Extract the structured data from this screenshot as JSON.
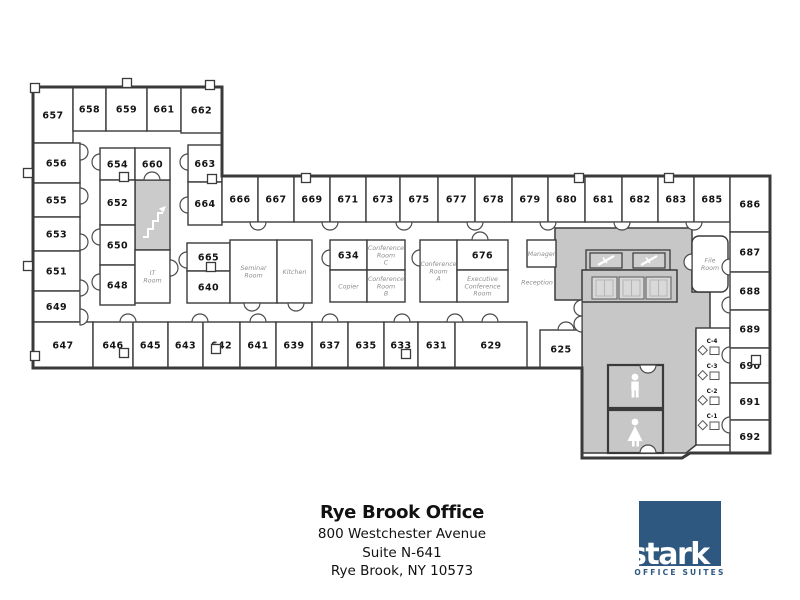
{
  "footer": {
    "title": "Rye Brook Office",
    "address_line1": "800 Westchester Avenue",
    "address_line2": "Suite N-641",
    "address_line3": "Rye Brook, NY 10573"
  },
  "logo": {
    "wordmark": "stark",
    "tagline": "OFFICE SUITES",
    "color": "#2e5880"
  },
  "colors": {
    "wall": "#3a3a3a",
    "room_fill": "#ffffff",
    "core_fill": "#c7c7c7",
    "stairs_fill": "#cbcbcb",
    "elevator_panel": "#d9d9d9",
    "number_label": "#141414",
    "name_label": "#8f8f8f"
  },
  "floorplan": {
    "outline": "M33,87 L222,87 L222,176 L770,176 L770,453 L690,453 L682,458 L582,458 L582,368 L33,368 Z",
    "core_path": "M555,228 L692,228 L692,292 L710,292 L710,330 L696,330 L696,445 L686,453 L582,453 L582,300 L555,300 Z",
    "stairs": {
      "x": 135,
      "y": 180,
      "w": 35,
      "h": 70
    },
    "strip": {
      "x": 696,
      "y": 328,
      "w": 34,
      "h": 117
    },
    "elevator": {
      "band": {
        "x": 586,
        "y": 250,
        "w": 84,
        "h": 20
      },
      "shafts": [
        {
          "x": 590,
          "y": 253,
          "w": 32,
          "h": 15
        },
        {
          "x": 633,
          "y": 253,
          "w": 32,
          "h": 15
        }
      ],
      "lobby": {
        "x": 582,
        "y": 270,
        "w": 95,
        "h": 32
      },
      "doors": [
        {
          "x": 592,
          "y": 277,
          "w": 25,
          "h": 22
        },
        {
          "x": 619,
          "y": 277,
          "w": 25,
          "h": 22
        },
        {
          "x": 646,
          "y": 277,
          "w": 25,
          "h": 22
        }
      ]
    },
    "restrooms": {
      "mens": {
        "x": 608,
        "y": 365,
        "w": 55,
        "h": 43
      },
      "womens": {
        "x": 608,
        "y": 410,
        "w": 55,
        "h": 43
      }
    },
    "rooms": [
      {
        "id": "657",
        "kind": "num",
        "lines": [
          "657"
        ],
        "x": 33,
        "y": 87,
        "w": 40,
        "h": 56
      },
      {
        "id": "658",
        "kind": "num",
        "lines": [
          "658"
        ],
        "x": 73,
        "y": 87,
        "w": 33,
        "h": 44
      },
      {
        "id": "659",
        "kind": "num",
        "lines": [
          "659"
        ],
        "x": 106,
        "y": 87,
        "w": 41,
        "h": 44
      },
      {
        "id": "661",
        "kind": "num",
        "lines": [
          "661"
        ],
        "x": 147,
        "y": 87,
        "w": 34,
        "h": 44
      },
      {
        "id": "662",
        "kind": "num",
        "lines": [
          "662"
        ],
        "x": 181,
        "y": 87,
        "w": 41,
        "h": 46
      },
      {
        "id": "656",
        "kind": "num",
        "lines": [
          "656"
        ],
        "x": 33,
        "y": 143,
        "w": 47,
        "h": 40
      },
      {
        "id": "655",
        "kind": "num",
        "lines": [
          "655"
        ],
        "x": 33,
        "y": 183,
        "w": 47,
        "h": 34
      },
      {
        "id": "653",
        "kind": "num",
        "lines": [
          "653"
        ],
        "x": 33,
        "y": 217,
        "w": 47,
        "h": 34
      },
      {
        "id": "651",
        "kind": "num",
        "lines": [
          "651"
        ],
        "x": 33,
        "y": 251,
        "w": 47,
        "h": 40
      },
      {
        "id": "649",
        "kind": "num",
        "lines": [
          "649"
        ],
        "x": 33,
        "y": 291,
        "w": 47,
        "h": 31
      },
      {
        "id": "647",
        "kind": "num",
        "lines": [
          "647"
        ],
        "x": 33,
        "y": 322,
        "w": 60,
        "h": 46
      },
      {
        "id": "654",
        "kind": "num",
        "lines": [
          "654"
        ],
        "x": 100,
        "y": 148,
        "w": 35,
        "h": 32
      },
      {
        "id": "660",
        "kind": "num",
        "lines": [
          "660"
        ],
        "x": 135,
        "y": 148,
        "w": 35,
        "h": 32
      },
      {
        "id": "652",
        "kind": "num",
        "lines": [
          "652"
        ],
        "x": 100,
        "y": 180,
        "w": 35,
        "h": 45
      },
      {
        "id": "650",
        "kind": "num",
        "lines": [
          "650"
        ],
        "x": 100,
        "y": 225,
        "w": 35,
        "h": 40
      },
      {
        "id": "648",
        "kind": "num",
        "lines": [
          "648"
        ],
        "x": 100,
        "y": 265,
        "w": 35,
        "h": 40
      },
      {
        "id": "it-room",
        "kind": "name",
        "lines": [
          "IT",
          "Room"
        ],
        "x": 135,
        "y": 250,
        "w": 35,
        "h": 53
      },
      {
        "id": "663",
        "kind": "num",
        "lines": [
          "663"
        ],
        "x": 188,
        "y": 145,
        "w": 34,
        "h": 37
      },
      {
        "id": "664",
        "kind": "num",
        "lines": [
          "664"
        ],
        "x": 188,
        "y": 182,
        "w": 34,
        "h": 43
      },
      {
        "id": "665",
        "kind": "num",
        "lines": [
          "665"
        ],
        "x": 187,
        "y": 243,
        "w": 43,
        "h": 28
      },
      {
        "id": "640",
        "kind": "num",
        "lines": [
          "640"
        ],
        "x": 187,
        "y": 271,
        "w": 43,
        "h": 32
      },
      {
        "id": "seminar-room",
        "kind": "name",
        "lines": [
          "Seminar",
          "Room"
        ],
        "x": 230,
        "y": 240,
        "w": 47,
        "h": 63
      },
      {
        "id": "kitchen",
        "kind": "name",
        "lines": [
          "Kitchen"
        ],
        "x": 277,
        "y": 240,
        "w": 35,
        "h": 63
      },
      {
        "id": "666",
        "kind": "num",
        "lines": [
          "666"
        ],
        "x": 222,
        "y": 176,
        "w": 36,
        "h": 46
      },
      {
        "id": "667",
        "kind": "num",
        "lines": [
          "667"
        ],
        "x": 258,
        "y": 176,
        "w": 36,
        "h": 46
      },
      {
        "id": "669",
        "kind": "num",
        "lines": [
          "669"
        ],
        "x": 294,
        "y": 176,
        "w": 36,
        "h": 46
      },
      {
        "id": "671",
        "kind": "num",
        "lines": [
          "671"
        ],
        "x": 330,
        "y": 176,
        "w": 36,
        "h": 46
      },
      {
        "id": "673",
        "kind": "num",
        "lines": [
          "673"
        ],
        "x": 366,
        "y": 176,
        "w": 34,
        "h": 46
      },
      {
        "id": "675",
        "kind": "num",
        "lines": [
          "675"
        ],
        "x": 400,
        "y": 176,
        "w": 38,
        "h": 46
      },
      {
        "id": "677",
        "kind": "num",
        "lines": [
          "677"
        ],
        "x": 438,
        "y": 176,
        "w": 37,
        "h": 46
      },
      {
        "id": "678",
        "kind": "num",
        "lines": [
          "678"
        ],
        "x": 475,
        "y": 176,
        "w": 37,
        "h": 46
      },
      {
        "id": "679",
        "kind": "num",
        "lines": [
          "679"
        ],
        "x": 512,
        "y": 176,
        "w": 36,
        "h": 46
      },
      {
        "id": "680",
        "kind": "num",
        "lines": [
          "680"
        ],
        "x": 548,
        "y": 176,
        "w": 37,
        "h": 46
      },
      {
        "id": "681",
        "kind": "num",
        "lines": [
          "681"
        ],
        "x": 585,
        "y": 176,
        "w": 37,
        "h": 46
      },
      {
        "id": "682",
        "kind": "num",
        "lines": [
          "682"
        ],
        "x": 622,
        "y": 176,
        "w": 36,
        "h": 46
      },
      {
        "id": "683",
        "kind": "num",
        "lines": [
          "683"
        ],
        "x": 658,
        "y": 176,
        "w": 36,
        "h": 46
      },
      {
        "id": "685",
        "kind": "num",
        "lines": [
          "685"
        ],
        "x": 694,
        "y": 176,
        "w": 36,
        "h": 46
      },
      {
        "id": "686",
        "kind": "num",
        "lines": [
          "686"
        ],
        "x": 730,
        "y": 176,
        "w": 40,
        "h": 56
      },
      {
        "id": "687",
        "kind": "num",
        "lines": [
          "687"
        ],
        "x": 730,
        "y": 232,
        "w": 40,
        "h": 40
      },
      {
        "id": "688",
        "kind": "num",
        "lines": [
          "688"
        ],
        "x": 730,
        "y": 272,
        "w": 40,
        "h": 38
      },
      {
        "id": "689",
        "kind": "num",
        "lines": [
          "689"
        ],
        "x": 730,
        "y": 310,
        "w": 40,
        "h": 38
      },
      {
        "id": "690",
        "kind": "num",
        "lines": [
          "690"
        ],
        "x": 730,
        "y": 348,
        "w": 40,
        "h": 35
      },
      {
        "id": "691",
        "kind": "num",
        "lines": [
          "691"
        ],
        "x": 730,
        "y": 383,
        "w": 40,
        "h": 37
      },
      {
        "id": "692",
        "kind": "num",
        "lines": [
          "692"
        ],
        "x": 730,
        "y": 420,
        "w": 40,
        "h": 33
      },
      {
        "id": "634",
        "kind": "num",
        "lines": [
          "634"
        ],
        "x": 330,
        "y": 240,
        "w": 37,
        "h": 30
      },
      {
        "id": "conference-room-c",
        "kind": "name",
        "lines": [
          "Conference",
          "Room",
          "C"
        ],
        "x": 367,
        "y": 240,
        "w": 38,
        "h": 30
      },
      {
        "id": "copier",
        "kind": "name",
        "lines": [
          "Copier"
        ],
        "x": 330,
        "y": 270,
        "w": 37,
        "h": 32
      },
      {
        "id": "conference-room-b",
        "kind": "name",
        "lines": [
          "Conference",
          "Room",
          "B"
        ],
        "x": 367,
        "y": 270,
        "w": 38,
        "h": 32
      },
      {
        "id": "conference-room-a",
        "kind": "name",
        "lines": [
          "Conference",
          "Room",
          "A"
        ],
        "x": 420,
        "y": 240,
        "w": 37,
        "h": 62
      },
      {
        "id": "676",
        "kind": "num",
        "lines": [
          "676"
        ],
        "x": 457,
        "y": 240,
        "w": 51,
        "h": 30
      },
      {
        "id": "executive-conference-room",
        "kind": "name",
        "lines": [
          "Executive",
          "Conference",
          "Room"
        ],
        "x": 457,
        "y": 270,
        "w": 51,
        "h": 32
      },
      {
        "id": "manager",
        "kind": "name",
        "lines": [
          "Manager"
        ],
        "x": 527,
        "y": 240,
        "w": 29,
        "h": 27
      },
      {
        "id": "reception",
        "kind": "label",
        "lines": [
          "Reception"
        ],
        "x": 515,
        "y": 265,
        "w": 44,
        "h": 34
      },
      {
        "id": "file-room",
        "kind": "name",
        "lines": [
          "File",
          "Room"
        ],
        "x": 692,
        "y": 236,
        "w": 36,
        "h": 56,
        "rx": 7
      },
      {
        "id": "646",
        "kind": "num",
        "lines": [
          "646"
        ],
        "x": 93,
        "y": 322,
        "w": 40,
        "h": 46
      },
      {
        "id": "645",
        "kind": "num",
        "lines": [
          "645"
        ],
        "x": 133,
        "y": 322,
        "w": 35,
        "h": 46
      },
      {
        "id": "643",
        "kind": "num",
        "lines": [
          "643"
        ],
        "x": 168,
        "y": 322,
        "w": 35,
        "h": 46
      },
      {
        "id": "642",
        "kind": "num",
        "lines": [
          "642"
        ],
        "x": 203,
        "y": 322,
        "w": 37,
        "h": 46
      },
      {
        "id": "641",
        "kind": "num",
        "lines": [
          "641"
        ],
        "x": 240,
        "y": 322,
        "w": 36,
        "h": 46
      },
      {
        "id": "639",
        "kind": "num",
        "lines": [
          "639"
        ],
        "x": 276,
        "y": 322,
        "w": 36,
        "h": 46
      },
      {
        "id": "637",
        "kind": "num",
        "lines": [
          "637"
        ],
        "x": 312,
        "y": 322,
        "w": 36,
        "h": 46
      },
      {
        "id": "635",
        "kind": "num",
        "lines": [
          "635"
        ],
        "x": 348,
        "y": 322,
        "w": 36,
        "h": 46
      },
      {
        "id": "633",
        "kind": "num",
        "lines": [
          "633"
        ],
        "x": 384,
        "y": 322,
        "w": 34,
        "h": 46
      },
      {
        "id": "631",
        "kind": "num",
        "lines": [
          "631"
        ],
        "x": 418,
        "y": 322,
        "w": 37,
        "h": 46
      },
      {
        "id": "629",
        "kind": "num",
        "lines": [
          "629"
        ],
        "x": 455,
        "y": 322,
        "w": 72,
        "h": 46
      },
      {
        "id": "625",
        "kind": "num",
        "lines": [
          "625"
        ],
        "x": 540,
        "y": 330,
        "w": 42,
        "h": 38
      }
    ],
    "cubicles": [
      {
        "label": "C-4",
        "y": 341
      },
      {
        "label": "C-3",
        "y": 366
      },
      {
        "label": "C-2",
        "y": 391
      },
      {
        "label": "C-1",
        "y": 416
      }
    ],
    "doors": [
      [
        258,
        222,
        180
      ],
      [
        330,
        222,
        180
      ],
      [
        404,
        222,
        180
      ],
      [
        475,
        222,
        180
      ],
      [
        548,
        222,
        180
      ],
      [
        622,
        222,
        180
      ],
      [
        694,
        222,
        180
      ],
      [
        128,
        322,
        0
      ],
      [
        200,
        322,
        0
      ],
      [
        258,
        322,
        0
      ],
      [
        330,
        322,
        0
      ],
      [
        402,
        322,
        0
      ],
      [
        455,
        322,
        0
      ],
      [
        490,
        322,
        0
      ],
      [
        566,
        330,
        0
      ],
      [
        80,
        152,
        90
      ],
      [
        80,
        196,
        90
      ],
      [
        80,
        242,
        90
      ],
      [
        80,
        288,
        90
      ],
      [
        80,
        317,
        90
      ],
      [
        100,
        162,
        270
      ],
      [
        100,
        237,
        270
      ],
      [
        100,
        282,
        270
      ],
      [
        188,
        162,
        270
      ],
      [
        188,
        205,
        270
      ],
      [
        187,
        260,
        270
      ],
      [
        170,
        268,
        90
      ],
      [
        152,
        180,
        0
      ],
      [
        252,
        303,
        180
      ],
      [
        296,
        303,
        180
      ],
      [
        330,
        258,
        270
      ],
      [
        420,
        258,
        270
      ],
      [
        480,
        240,
        0
      ],
      [
        582,
        308,
        270
      ],
      [
        582,
        324,
        270
      ],
      [
        692,
        262,
        270
      ],
      [
        730,
        267,
        270
      ],
      [
        730,
        305,
        270
      ],
      [
        730,
        355,
        270
      ],
      [
        730,
        425,
        270
      ],
      [
        648,
        365,
        180
      ],
      [
        648,
        453,
        0
      ]
    ],
    "tabs": [
      [
        35,
        88
      ],
      [
        127,
        83
      ],
      [
        210,
        85
      ],
      [
        28,
        173
      ],
      [
        28,
        266
      ],
      [
        35,
        356
      ],
      [
        124,
        353
      ],
      [
        216,
        349
      ],
      [
        406,
        354
      ],
      [
        306,
        178
      ],
      [
        579,
        178
      ],
      [
        669,
        178
      ],
      [
        756,
        360
      ],
      [
        124,
        177
      ],
      [
        211,
        267
      ],
      [
        212,
        179
      ]
    ]
  }
}
